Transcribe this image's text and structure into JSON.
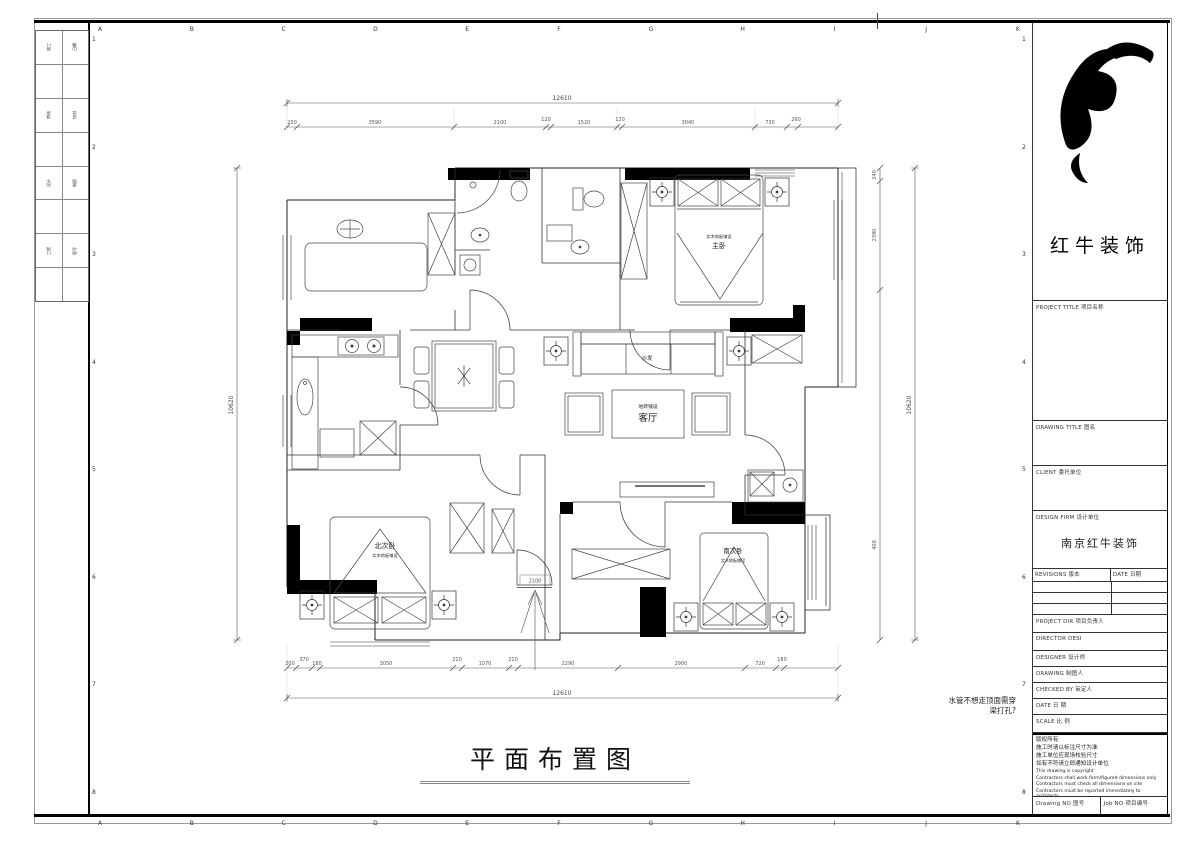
{
  "colors": {
    "ink": "#1a1a1a",
    "paper": "#ffffff"
  },
  "frame": {
    "grid_letters": [
      "A",
      "B",
      "C",
      "D",
      "E",
      "F",
      "G",
      "H",
      "I",
      "J",
      "K"
    ],
    "row_numbers": [
      "1",
      "2",
      "3",
      "4",
      "5",
      "6",
      "7",
      "8"
    ]
  },
  "left_strip": {
    "pairs": [
      [
        "竣工",
        "日期"
      ],
      [
        "审核",
        "校对"
      ],
      [
        "设计",
        "制图"
      ],
      [
        "工程",
        "图号"
      ]
    ]
  },
  "title_block": {
    "company": "红牛装饰",
    "project_title": "PROJECT TITLE  项目名称",
    "drawing_title": "DRAWING TITLE  图名",
    "client": "CLIENT  委托单位",
    "design_firm": "DESIGN FIRM  设计单位",
    "design_firm_value": "南京红牛装饰",
    "revisions": "REVISIONS  版本",
    "rev_date": "DATE  日期",
    "project_dir": "PROJECT DIR  项目负责人",
    "director": "DIRECTOR DESI",
    "designer": "DESIGNER    设计师",
    "drawing": "DRAWING     制图人",
    "checked_by": "CHECKED BY  审定人",
    "date": "DATE        日  期",
    "scale": "SCALE       比  例",
    "copyright": [
      "版权所有",
      "施工时请以标注尺寸为准",
      "施工单位应现场校验尺寸",
      "如有不符请立即通知设计单位",
      "This drawing is copyright",
      "Contractors shall work form/figured dimensions only",
      "Contractors must check all dimensions on site",
      "Contractors must be reported immediately to architects"
    ],
    "drawing_no": "Drawing NO  图号",
    "job_no": "Job NO  项目编号"
  },
  "plan": {
    "title": "平面布置图",
    "note_line1": "水管不想走顶面需穿",
    "note_line2": "梁打孔?",
    "entry_width": "2100",
    "rooms": {
      "living": "客厅",
      "living_sub": "地砖铺设",
      "sofa": "沙发",
      "master": "主卧",
      "master_sub": "实木地板铺设",
      "north": "北次卧",
      "north_sub": "实木地板铺设",
      "south": "南次卧",
      "south_sub": "实木地板铺设"
    },
    "dims": {
      "top_total": "12610",
      "top_segs": [
        "230",
        "3590",
        "2100",
        "120",
        "1520",
        "120",
        "3040",
        "730",
        "260"
      ],
      "bottom_total": "12610",
      "bottom_segs": [
        "200",
        "370",
        "180",
        "3050",
        "210",
        "1070",
        "210",
        "2290",
        "2900",
        "720",
        "180"
      ],
      "left_total": "10620",
      "right_total": "10620",
      "right_segs": [
        "240",
        "2390",
        "400"
      ]
    }
  }
}
